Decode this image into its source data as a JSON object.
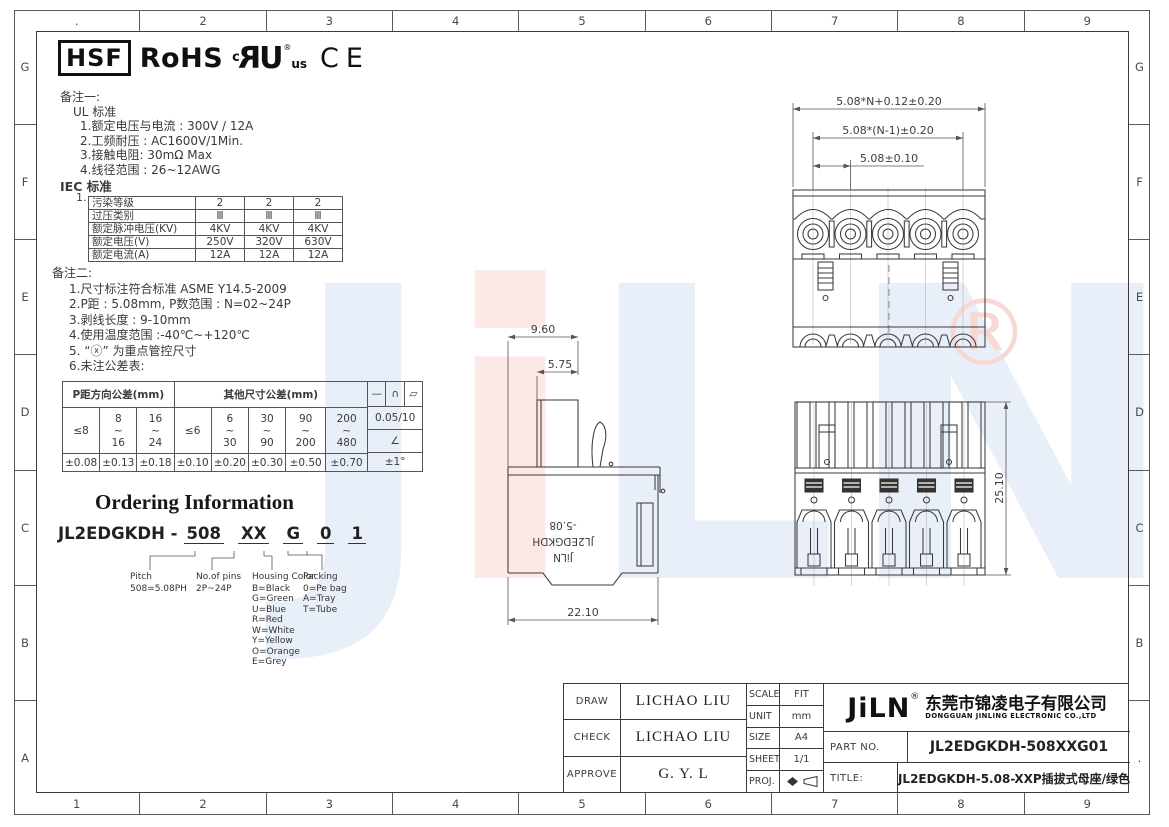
{
  "sheet": {
    "columns_top": [
      ".",
      "2",
      "3",
      "4",
      "5",
      "6",
      "7",
      "8",
      "9"
    ],
    "columns_bottom": [
      "1",
      "2",
      "3",
      "4",
      "5",
      "6",
      "7",
      "8",
      "9"
    ],
    "rows_left": [
      "G",
      "F",
      "E",
      "D",
      "C",
      "B",
      "A"
    ],
    "rows_right": [
      "G",
      "F",
      "E",
      "D",
      "C",
      "B",
      "."
    ]
  },
  "certifications": {
    "hsf": "HSF",
    "rohs": "RoHS",
    "ul_c": "c",
    "ul_mark": "UR",
    "ul_reg": "®",
    "ul_us": "us",
    "ce": "CE"
  },
  "notes1": {
    "lines": [
      {
        "t": "备注一:",
        "i": 0
      },
      {
        "t": "UL 标准",
        "i": 13
      },
      {
        "t": "1.额定电压与电流 : 300V / 12A",
        "i": 20
      },
      {
        "t": "2.工频耐压 : AC1600V/1Min.",
        "i": 20
      },
      {
        "t": "3.接触电阻: 30mΩ Max",
        "i": 20
      },
      {
        "t": "4.线径范围 : 26~12AWG",
        "i": 20
      }
    ]
  },
  "iec": {
    "title": "IEC 标准",
    "item_no": "1.",
    "rows": [
      [
        "污染等级",
        "2",
        "2",
        "2"
      ],
      [
        "过压类别",
        "Ⅲ",
        "Ⅲ",
        "Ⅲ"
      ],
      [
        "额定脉冲电压(KV)",
        "4KV",
        "4KV",
        "4KV"
      ],
      [
        "额定电压(V)",
        "250V",
        "320V",
        "630V"
      ],
      [
        "额定电流(A)",
        "12A",
        "12A",
        "12A"
      ]
    ]
  },
  "notes2": {
    "lines": [
      {
        "t": "备注二:",
        "i": 0
      },
      {
        "t": "1.尺寸标注符合标准 ASME Y14.5-2009",
        "i": 17
      },
      {
        "t": "2.P距 : 5.08mm, P数范围 : N=02~24P",
        "i": 17
      },
      {
        "t": "3.剥线长度 : 9-10mm",
        "i": 17
      },
      {
        "t": "4.使用温度范围 :-40℃~+120℃",
        "i": 17
      },
      {
        "t": "5. “ⓧ” 为重点管控尺寸",
        "i": 17
      },
      {
        "t": "6.未注公差表:",
        "i": 17
      }
    ]
  },
  "tolerance": {
    "p_header": "P距方向公差(mm)",
    "other_header": "其他尺寸公差(mm)",
    "p_ranges": [
      "≤8",
      "8\n~\n16",
      "16\n~\n24"
    ],
    "p_values": [
      "±0.08",
      "±0.13",
      "±0.18"
    ],
    "other_ranges": [
      "≤6",
      "6\n~\n30",
      "30\n~\n90",
      "90\n~\n200",
      "200\n~\n480"
    ],
    "other_values": [
      "±0.10",
      "±0.20",
      "±0.30",
      "±0.50",
      "±0.70"
    ],
    "symbols": [
      "—",
      "∩",
      "▱"
    ],
    "flatness_value": "0.05/10",
    "angle_symbol": "∠",
    "angle_tolerance": "±1°"
  },
  "ordering": {
    "title": "Ordering Information",
    "prefix": "JL2EDGKDH - ",
    "segments": [
      "508",
      "XX",
      "G",
      "0",
      "1"
    ],
    "callouts": [
      {
        "label": "Pitch",
        "lines": [
          "508=5.08PH"
        ]
      },
      {
        "label": "No.of pins",
        "lines": [
          "2P~24P"
        ]
      },
      {
        "label": "Housing Color",
        "lines": [
          "B=Black",
          "G=Green",
          "U=Blue",
          "R=Red",
          "W=White",
          "Y=Yellow",
          "O=Orange",
          "E=Grey"
        ]
      },
      {
        "label": "Packing",
        "lines": [
          "0=Pe bag",
          "A=Tray",
          "T=Tube"
        ]
      }
    ]
  },
  "drawings": {
    "top_view": {
      "dims": [
        "5.08*N+0.12±0.20",
        "5.08*(N-1)±0.20",
        "5.08±0.10"
      ]
    },
    "side_view": {
      "dim_top": "9.60",
      "dim_mid": "5.75",
      "dim_bottom": "22.10",
      "marking_lines": [
        "JiLN",
        "JL2EDGKDH",
        "-5.08"
      ]
    },
    "front_view": {
      "dim_height": "25.10"
    }
  },
  "title_block": {
    "draw_label": "DRAW",
    "draw": "LICHAO LIU",
    "check_label": "CHECK",
    "check": "LICHAO LIU",
    "approve_label": "APPROVE",
    "approve": "G. Y. L",
    "scale_label": "SCALE",
    "scale": "FIT",
    "unit_label": "UNIT",
    "unit": "mm",
    "size_label": "SIZE",
    "size": "A4",
    "sheet_label": "SHEET",
    "sheet": "1/1",
    "proj_label": "PROJ.",
    "brand": "JiLN",
    "brand_reg": "®",
    "company_cn": "东莞市锦凌电子有限公司",
    "company_en": "DONGGUAN JINLING ELECTRONIC CO.,LTD",
    "part_no_label": "PART NO.",
    "part_no": "JL2EDGKDH-508XXG01",
    "title_label": "TITLE:",
    "title": "JL2EDGKDH-5.08-XXP插拔式母座/绿色"
  },
  "watermark": {
    "letters": [
      "J",
      "i",
      "L",
      "N"
    ],
    "reg": "®"
  },
  "colors": {
    "watermark_blue": "#e9eff8",
    "watermark_pink": "#fce8e5",
    "watermark_reg": "#f6d8d4",
    "line": "#3a3a3a"
  }
}
